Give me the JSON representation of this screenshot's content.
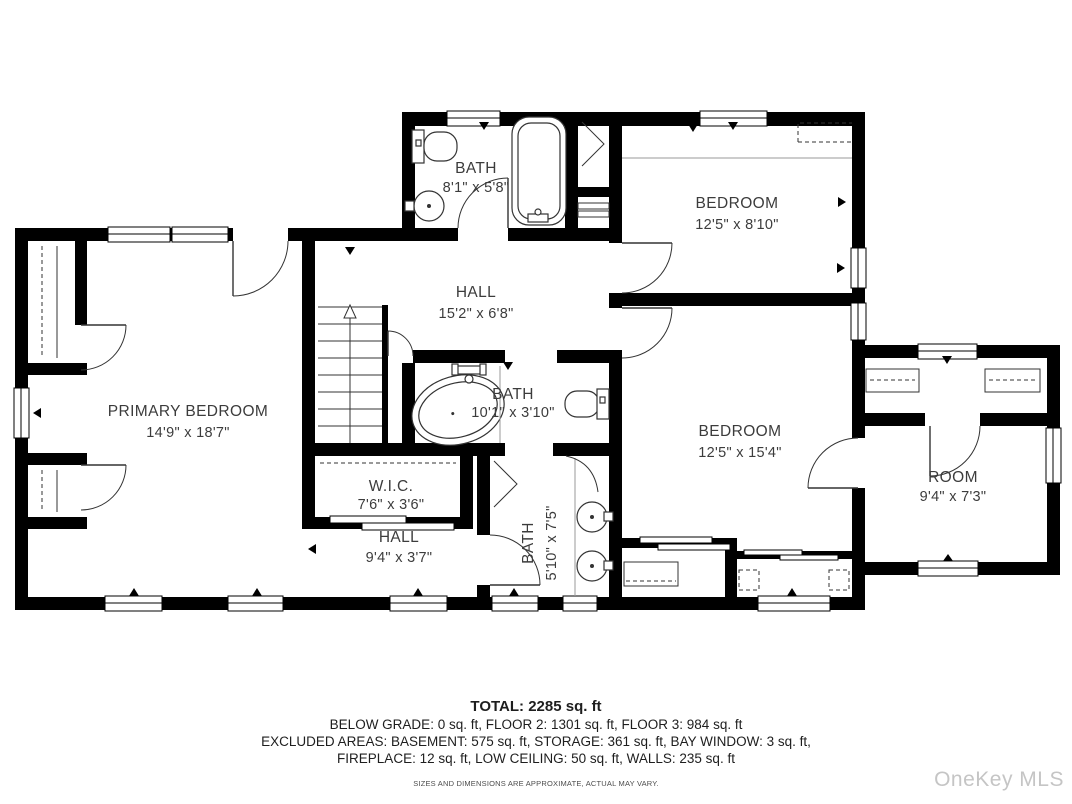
{
  "rooms": {
    "bath_top": {
      "name": "BATH",
      "dims": "8'1\" x 5'8\""
    },
    "bedroom_top": {
      "name": "BEDROOM",
      "dims": "12'5\" x 8'10\""
    },
    "hall_main": {
      "name": "HALL",
      "dims": "15'2\" x 6'8\""
    },
    "primary_bedroom": {
      "name": "PRIMARY BEDROOM",
      "dims": "14'9\" x 18'7\""
    },
    "bath_center": {
      "name": "BATH",
      "dims": "10'1\" x 3'10\""
    },
    "bedroom_right": {
      "name": "BEDROOM",
      "dims": "12'5\" x 15'4\""
    },
    "wic": {
      "name": "W.I.C.",
      "dims": "7'6\" x 3'6\""
    },
    "hall_lower": {
      "name": "HALL",
      "dims": "9'4\" x 3'7\""
    },
    "bath_lower": {
      "name": "BATH",
      "dims": "5'10\" x 7'5\""
    },
    "room_right": {
      "name": "ROOM",
      "dims": "9'4\" x 7'3\""
    }
  },
  "summary": {
    "total": "TOTAL: 2285 sq. ft",
    "line1": "BELOW GRADE: 0 sq. ft, FLOOR 2: 1301 sq. ft, FLOOR 3: 984 sq. ft",
    "line2": "EXCLUDED AREAS: BASEMENT: 575 sq. ft, STORAGE: 361 sq. ft, BAY WINDOW: 3 sq. ft,",
    "line3": "FIREPLACE: 12 sq. ft, LOW CEILING: 50 sq. ft, WALLS: 235 sq. ft",
    "disclaimer": "SIZES AND DIMENSIONS ARE APPROXIMATE, ACTUAL MAY VARY."
  },
  "watermark": "OneKey MLS",
  "colors": {
    "wall": "#000000",
    "label": "#3c3c3c",
    "watermark": "#c5c5c5"
  }
}
